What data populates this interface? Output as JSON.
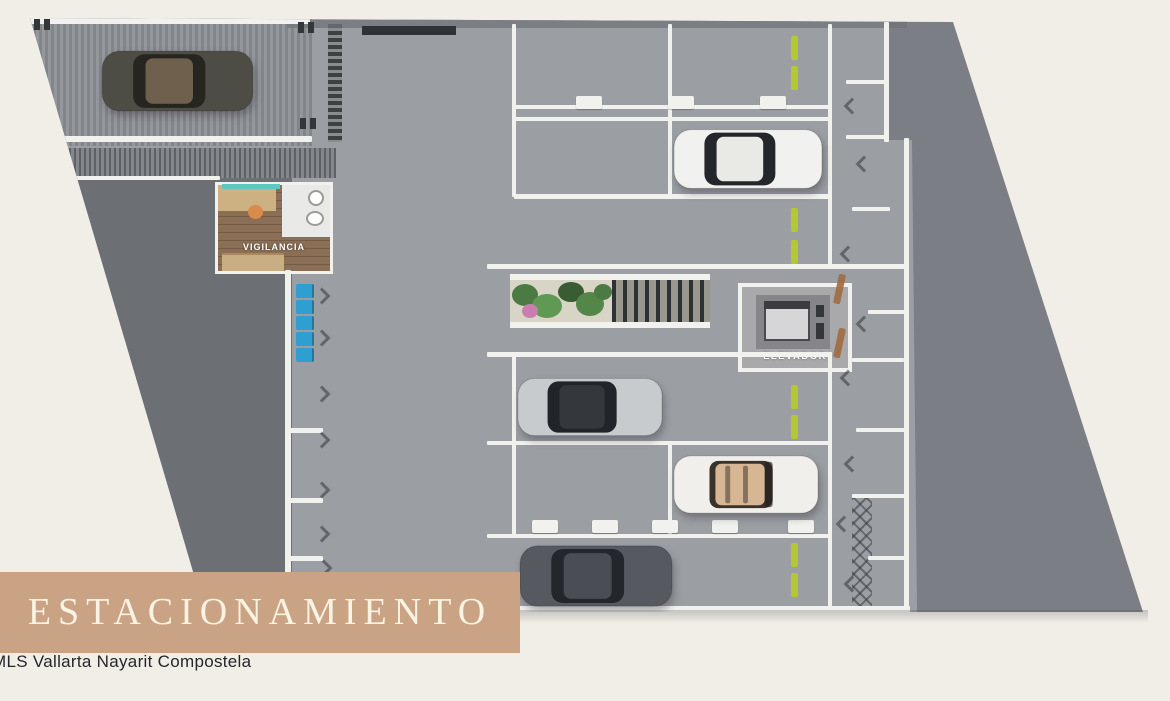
{
  "title_banner": {
    "label": "ESTACIONAMIENTO",
    "bg_color": "#c9a384",
    "text_color": "#f9f3e3"
  },
  "credit": {
    "label": "MLS Vallarta Nayarit Compostela",
    "text_color": "#26262a"
  },
  "rooms": {
    "vigilancia_label": "VIGILANCIA",
    "elevador_label": "ELEVADOR"
  },
  "colors": {
    "background": "#f1eee7",
    "floor": "#9b9ea3",
    "outer_band": "#7b7e84",
    "storage_zone": "#6c6f74",
    "wall_white": "#f1f1ee",
    "marker_green": "#b4c832",
    "bike_blue": "#2f9fd1",
    "door_tan": "#a06a3f",
    "planter_bed": "#d8d4c6",
    "plant_green": "#4c7a43",
    "plant_pink": "#c97fae",
    "wood_floor": "#8a6e55",
    "teal_accent": "#5cc8c2",
    "orange_accent": "#d98c4a"
  },
  "cars": [
    {
      "name": "dark olive car on ramp",
      "body_color": "#4d4c45",
      "roof_color": "#6f604e",
      "glass_color": "#26251f"
    },
    {
      "name": "white sedan",
      "body_color": "#f1f1ef",
      "roof_color": "#e9e9e6",
      "glass_color": "#23262a"
    },
    {
      "name": "silver car",
      "body_color": "#c8cbcd",
      "roof_color": "#34373b",
      "glass_color": "#212428"
    },
    {
      "name": "white convertible with tan interior",
      "body_color": "#f0efec",
      "roof_color": "#d7b694",
      "glass_color": "#3a332c"
    },
    {
      "name": "dark gray car",
      "body_color": "#565a60",
      "roof_color": "#4a4e54",
      "glass_color": "#23262a"
    }
  ]
}
